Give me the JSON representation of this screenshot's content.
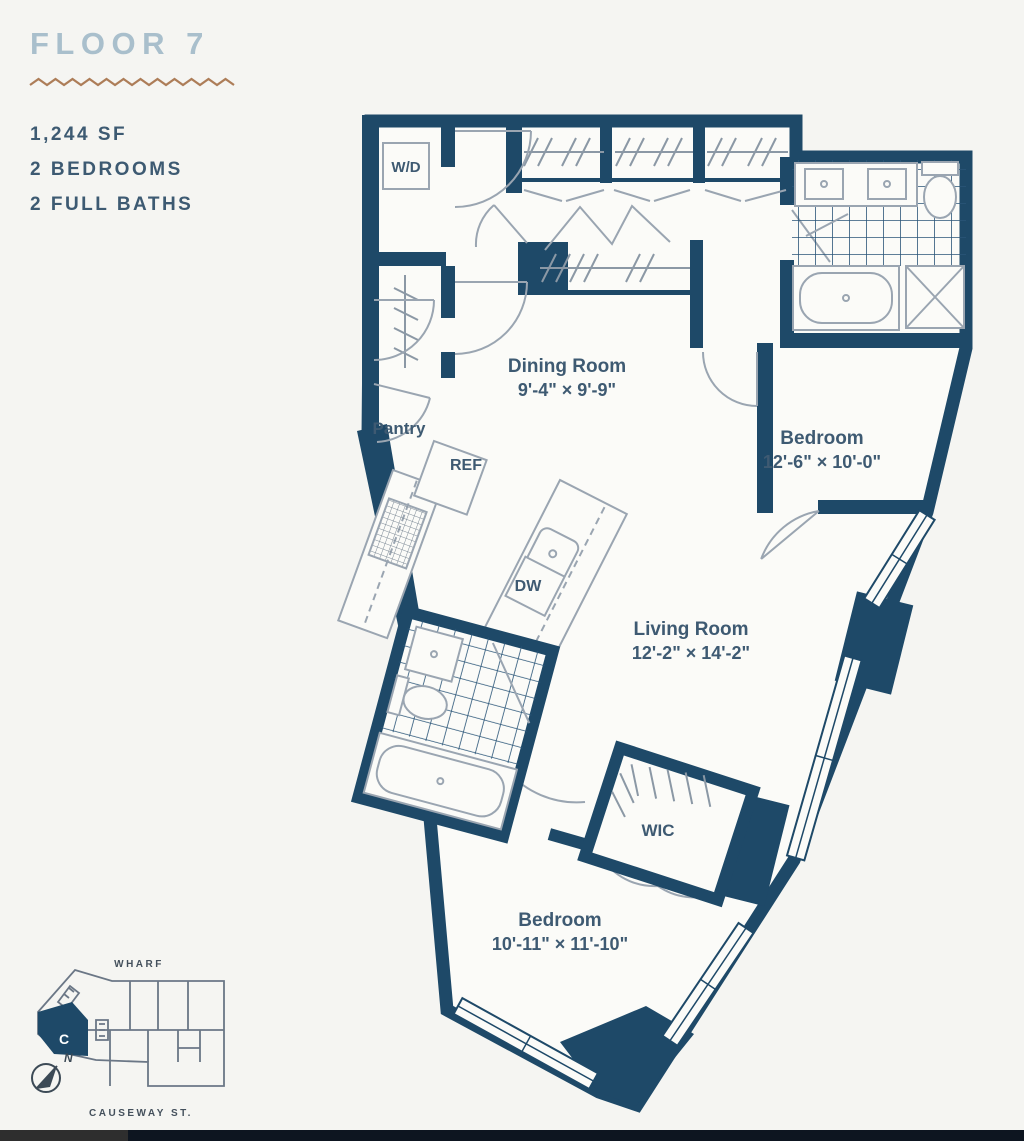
{
  "header": {
    "title": "FLOOR 7"
  },
  "summary": {
    "area": "1,244 SF",
    "bedrooms": "2 BEDROOMS",
    "bathrooms": "2 FULL BATHS"
  },
  "plan": {
    "rooms": [
      {
        "name": "Dining Room",
        "dims": "9'-4\" × 9'-9\""
      },
      {
        "name": "Bedroom",
        "dims": "12'-6\" × 10'-0\""
      },
      {
        "name": "Living Room",
        "dims": "12'-2\" × 14'-2\""
      },
      {
        "name": "Bedroom",
        "dims": "10'-11\" × 11'-10\""
      }
    ],
    "labels": {
      "washer_dryer": "W/D",
      "pantry": "Pantry",
      "refrigerator": "REF",
      "dishwasher": "DW",
      "walk_in_closet": "WIC"
    }
  },
  "key_plan": {
    "street_top": "WHARF",
    "street_bottom": "CAUSEWAY ST.",
    "unit_label": "C",
    "compass": "N"
  },
  "colors": {
    "wall": "#1e4968",
    "title": "#a9bfcc",
    "divider": "#ad7d58",
    "text": "#3d5a72"
  }
}
